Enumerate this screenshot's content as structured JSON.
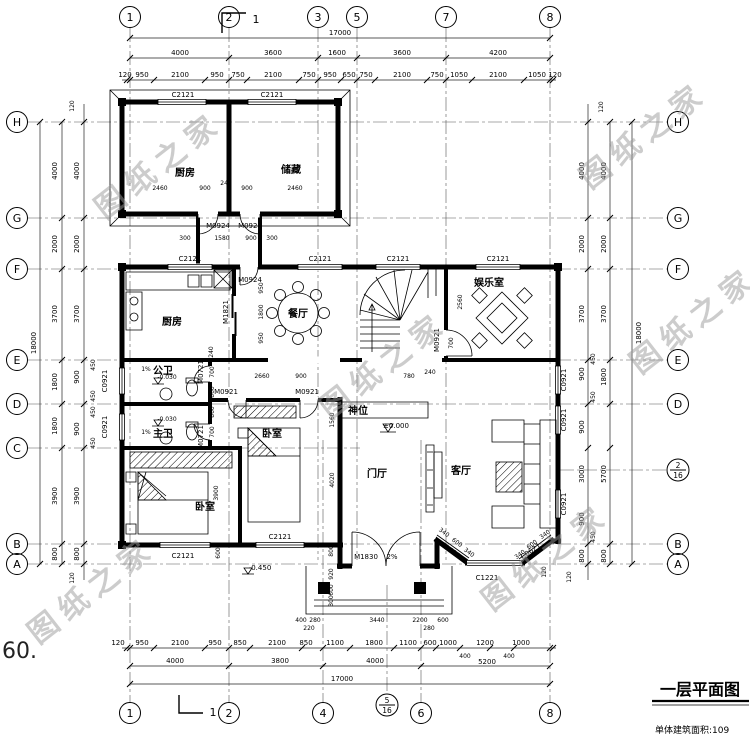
{
  "meta": {
    "note_left": "60.",
    "title": "一层平面图",
    "subtitle": "单体建筑面积:109",
    "section_mark": "1",
    "watermark": "图纸之家"
  },
  "axis": {
    "top": [
      "1",
      "2",
      "3",
      "5",
      "7",
      "8"
    ],
    "bottom": [
      "1",
      "2",
      "4",
      "6",
      "8"
    ],
    "left": [
      "H",
      "G",
      "F",
      "E",
      "D",
      "C",
      "B",
      "A"
    ],
    "right": [
      "H",
      "G",
      "F",
      "E",
      "D",
      "B",
      "A"
    ],
    "frac_right": [
      "2",
      "16"
    ],
    "frac_bottom": [
      "5",
      "16"
    ]
  },
  "dim": {
    "top_total": "17000",
    "bot_total": "17000",
    "side_total": "18000",
    "top_major": [
      "4000",
      "3600",
      "1600",
      "3600",
      "4200"
    ],
    "top_minor": [
      "120",
      "950",
      "2100",
      "950",
      "750",
      "2100",
      "750",
      "950",
      "650",
      "750",
      "2100",
      "750",
      "1050",
      "2100",
      "1050",
      "120"
    ],
    "bot_major": [
      "4000",
      "3800",
      "4000",
      "400",
      "5200",
      "400"
    ],
    "bot_minor": [
      "120",
      "950",
      "2100",
      "950",
      "850",
      "2100",
      "850",
      "1100",
      "1800",
      "1100",
      "600",
      "1000",
      "1200",
      "1000"
    ],
    "left_outer": [
      "4000",
      "2000",
      "3700",
      "1800",
      "1800",
      "3900",
      "800"
    ],
    "left_inner": [
      "4000",
      "2000",
      "3700",
      "900",
      "900",
      "3900",
      "800"
    ],
    "left_sub": [
      "450",
      "450",
      "450",
      "450"
    ],
    "left_off": [
      "120",
      "120"
    ],
    "right_inner": [
      "4000",
      "2000",
      "3700",
      "900",
      "900",
      "3000",
      "900",
      "800"
    ],
    "right_outer": [
      "4000",
      "2000",
      "3700",
      "1800",
      "5700",
      "800"
    ],
    "right_sub": [
      "450",
      "450",
      "450"
    ],
    "right_off": [
      "120",
      "120"
    ]
  },
  "inner": {
    "annex": [
      "2460",
      "900",
      "240",
      "900",
      "2460"
    ],
    "corridor": [
      "300",
      "1580",
      "900",
      "300"
    ],
    "dining": [
      "950",
      "1800",
      "950"
    ],
    "hall": [
      "2660",
      "900",
      "780",
      "240"
    ],
    "ent": [
      "2560",
      "700"
    ],
    "foyer": [
      "1560",
      "4020"
    ],
    "bed": [
      "3900",
      "600"
    ],
    "bath": [
      "240",
      "700",
      "860",
      "860",
      "700"
    ],
    "porch_v": [
      "800",
      "920",
      "600",
      "300"
    ],
    "porch_h": [
      "400",
      "280",
      "220",
      "3440",
      "2200",
      "280",
      "600"
    ],
    "bay_l": [
      "340",
      "600",
      "340"
    ],
    "bay_r": [
      "340",
      "600",
      "340"
    ],
    "bay_off": "120"
  },
  "open": {
    "c2121": "C2121",
    "c0921": "C0921",
    "c1221": "C1221",
    "c0621": "C0621",
    "m0924": "M0924",
    "m1821": "M1821",
    "m0921": "M0921",
    "m0721": "M0721",
    "m1830": "M1830",
    "slope2": "2%",
    "slope1": "1%"
  },
  "room": {
    "annex_kitchen": "厨房",
    "storage": "储藏",
    "kitchen": "厨房",
    "dining": "餐厅",
    "ent": "娱乐室",
    "pub_bath": "公卫",
    "mst_bath": "主卫",
    "bedroom_mid": "卧室",
    "bedroom_left": "卧室",
    "foyer": "门厅",
    "living": "客厅",
    "shrine": "神位"
  },
  "level": {
    "zero": "±0.000",
    "n030": "-0.030",
    "n450": "-0.450"
  }
}
